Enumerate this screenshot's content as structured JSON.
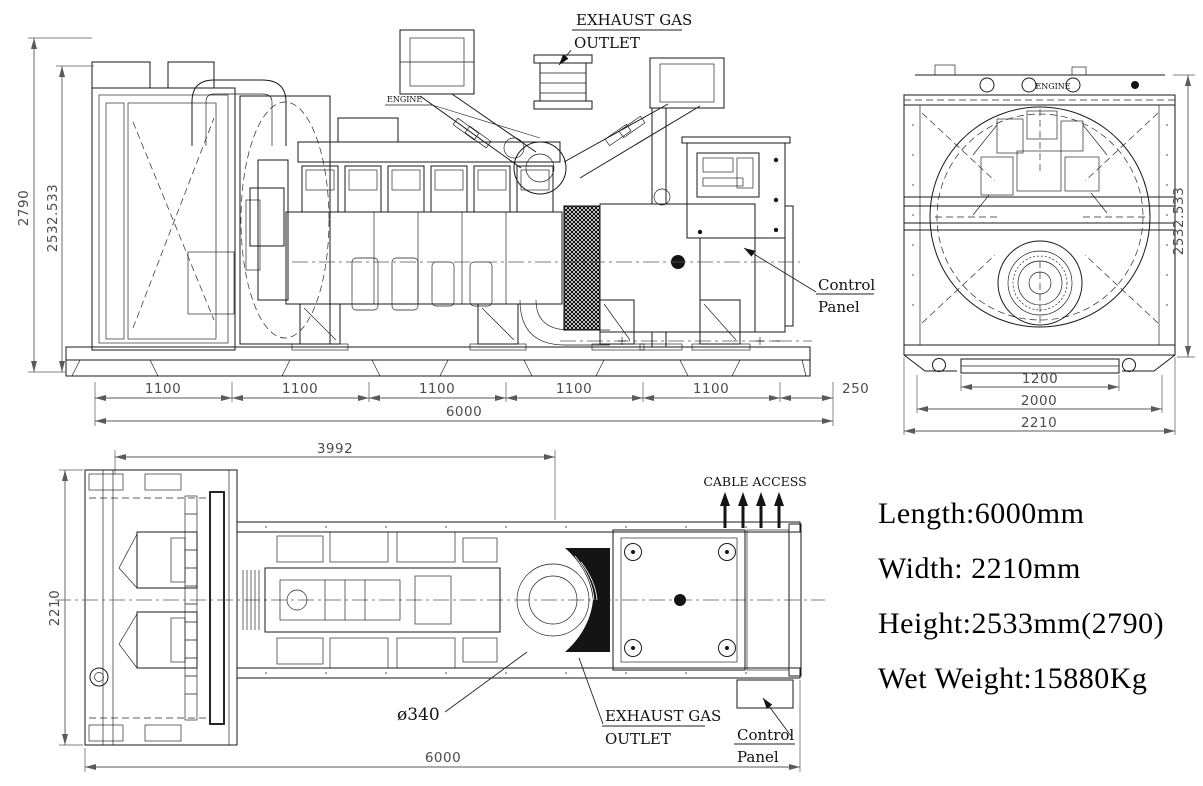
{
  "specs": {
    "length": "Length:6000mm",
    "width": "Width: 2210mm",
    "height": "Height:2533mm(2790)",
    "wet_weight": "Wet Weight:15880Kg"
  },
  "side_view": {
    "labels": {
      "exhaust_line1": "EXHAUST GAS",
      "exhaust_line2": "OUTLET",
      "engine": "ENGINE",
      "control_line1": "Control",
      "control_line2": "Panel"
    },
    "dims": {
      "overall_height": "2790",
      "canopy_height": "2532.533",
      "bay_spacings": [
        "1100",
        "1100",
        "1100",
        "1100",
        "1100"
      ],
      "end_offset": "250",
      "total_length": "6000"
    }
  },
  "end_view": {
    "labels": {
      "engine": "ENGINE"
    },
    "dims": {
      "base_width": "1200",
      "frame_width": "2000",
      "overall_width": "2210",
      "height": "2532.533"
    }
  },
  "plan_view": {
    "labels": {
      "cable_access": "CABLE ACCESS",
      "exhaust_diameter": "ø340",
      "exhaust_line1": "EXHAUST GAS",
      "exhaust_line2": "OUTLET",
      "control_line1": "Control",
      "control_line2": "Panel"
    },
    "dims": {
      "engine_length": "3992",
      "overall_width": "2210",
      "total_length": "6000"
    }
  }
}
